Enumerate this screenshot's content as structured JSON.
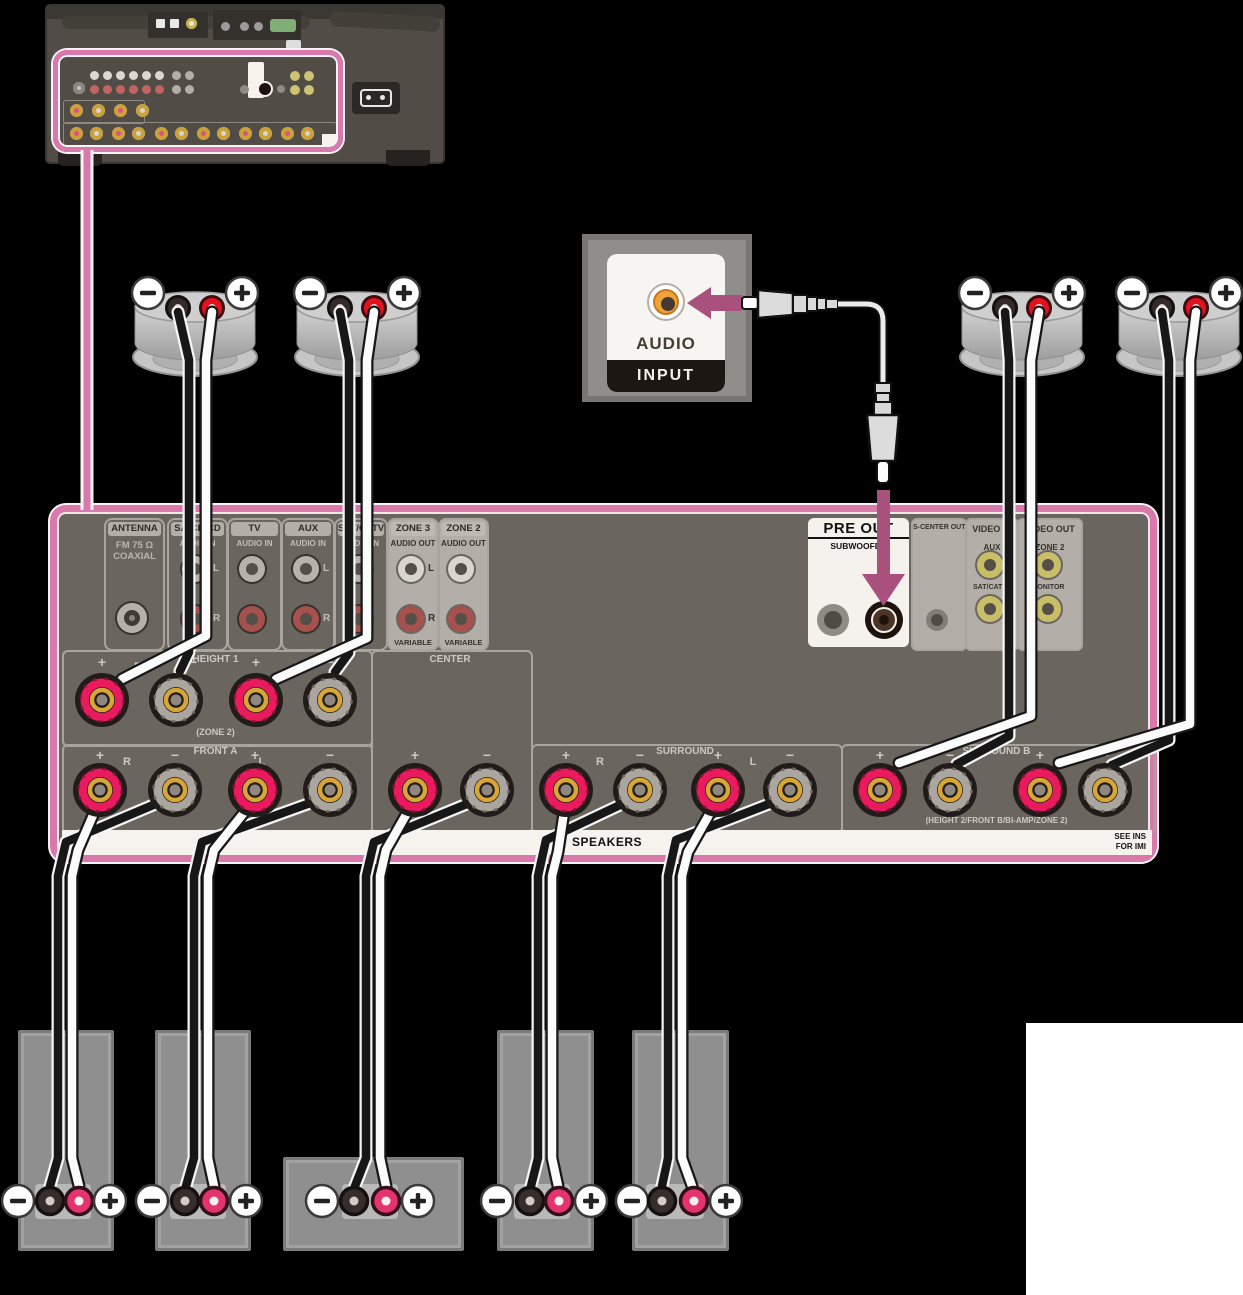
{
  "audio_input": {
    "label_top": "AUDIO",
    "label_bottom": "INPUT"
  },
  "panel": {
    "antenna": {
      "title": "ANTENNA",
      "line1": "FM 75 Ω",
      "line2": "COAXIAL"
    },
    "sacd": {
      "title": "SA-CD/CD",
      "sub": "AUDIO IN"
    },
    "tv": {
      "title": "TV",
      "sub": "AUDIO IN"
    },
    "aux": {
      "title": "AUX",
      "sub": "AUDIO IN"
    },
    "sat": {
      "title": "SAT/CATV",
      "sub": "AUDIO IN"
    },
    "zone3": {
      "title": "ZONE 3",
      "sub": "AUDIO OUT",
      "variable": "VARIABLE"
    },
    "zone2": {
      "title": "ZONE 2",
      "sub": "AUDIO OUT",
      "variable": "VARIABLE"
    },
    "preout": {
      "title": "PRE OUT",
      "sub": "SUBWOOFER"
    },
    "scenter": {
      "title": "S-CENTER OUT"
    },
    "videoin": {
      "title": "VIDEO IN",
      "jack_top": "AUX",
      "jack_bottom": "SAT/CATV"
    },
    "videoout": {
      "title": "VIDEO OUT",
      "jack_top": "ZONE 2",
      "jack_bottom": "MONITOR"
    }
  },
  "terminals": {
    "height1": {
      "label": "HEIGHT 1",
      "note": "(ZONE 2)"
    },
    "front_a": {
      "label": "FRONT A"
    },
    "center": {
      "label": "CENTER"
    },
    "surround": {
      "label": "SURROUND"
    },
    "surround_b": {
      "label": "SURROUND B",
      "note": "(HEIGHT 2/FRONT B/BI-AMP/ZONE 2)"
    },
    "strip_label": "SPEAKERS",
    "note_line1": "SEE INS",
    "note_line2": "FOR IMI"
  },
  "glyphs": {
    "plus": "+",
    "minus": "−",
    "left": "L",
    "right": "R"
  },
  "colors": {
    "highlight": "#d878ab",
    "arrow": "#a8517d",
    "terminal_red": "#ea1a5e",
    "terminal_gray": "#aaa69f",
    "panel": "#6b655f"
  }
}
